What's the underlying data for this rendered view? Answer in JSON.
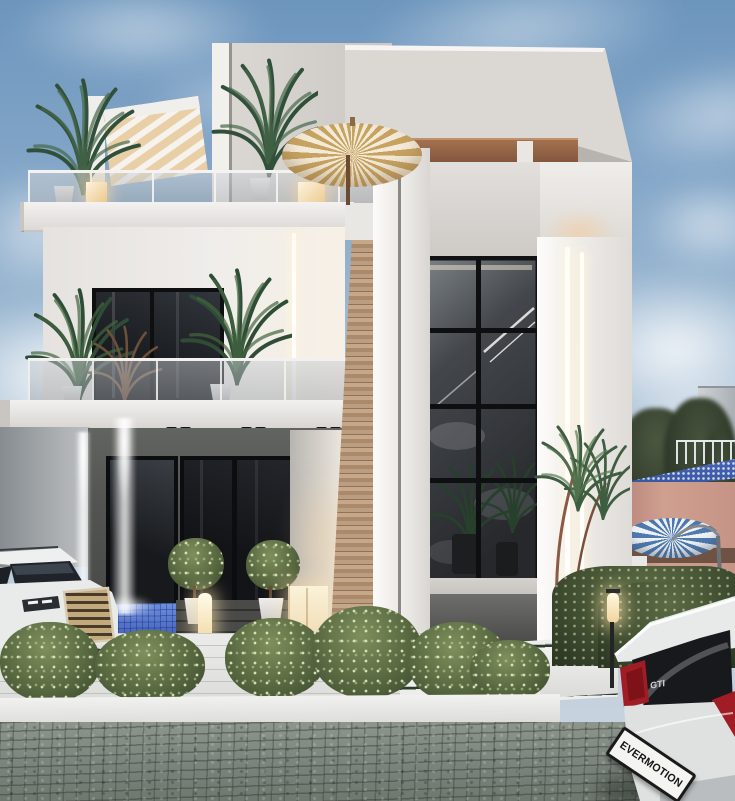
{
  "scene": {
    "title": "Modern white villa exterior - dusk 3D architectural render",
    "setting": "Two-storey contemporary house with rooftop terrace, glass balconies, water feature, landscaped forecourt and two cars",
    "time_of_day": "dusk"
  },
  "palette": {
    "sky_top": "#6d96bd",
    "sky_horizon": "#ccd6df",
    "cloud_white": "#f4f6f8",
    "facade_white": "#efedea",
    "facade_shadow": "#d5d2cf",
    "wood_slats": "#b08d6e",
    "roof_beam": "#96664a",
    "glass_dark": "#202428",
    "frame_black": "#121416",
    "led_warm_white": "#fff6e6",
    "umbrella_gold": "#c7a362",
    "umbrella_blue": "#4e7ab0",
    "mosaic_blue": "#5577cc",
    "foliage_green": "#55663f",
    "paving_gray": "#828b82",
    "taillight_red": "#a11d26",
    "tan_wall": "#c59486"
  },
  "building": {
    "floors": 3,
    "features": [
      "rooftop terrace with glass railing",
      "slatted pergola",
      "gold parasol",
      "double-height mullioned window",
      "vertical LED light strips",
      "wood slat accent column",
      "blue mosaic fountain basin",
      "recessed dark entry"
    ]
  },
  "landscape": {
    "features": [
      "palm planters",
      "flowering hedges",
      "topiary trees",
      "glowing bollard light",
      "glowing cube lamp",
      "cobblestone driveway",
      "white planter walls"
    ]
  },
  "background": {
    "features": [
      "neighbouring pool deck with blue parasol",
      "sun loungers",
      "distant building",
      "trees"
    ]
  },
  "vehicles": {
    "suv": {
      "label": "white SUV, front view",
      "position": "bottom left"
    },
    "hatchback": {
      "label": "white hatchback, rear view",
      "position": "bottom right",
      "plate_text": "EVERMOTION",
      "badge_text": "GTI"
    }
  }
}
